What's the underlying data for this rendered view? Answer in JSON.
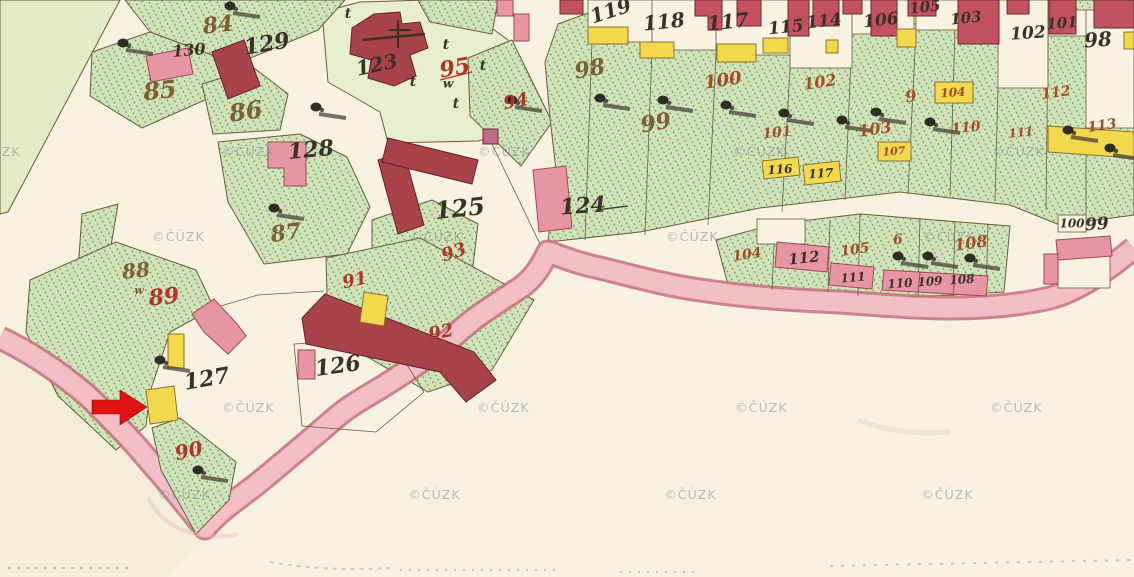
{
  "map": {
    "watermark": {
      "text": "©ČÚZK"
    },
    "watermark_positions": [
      [
        -32,
        156
      ],
      [
        222,
        156
      ],
      [
        478,
        156
      ],
      [
        733,
        156
      ],
      [
        992,
        156
      ],
      [
        152,
        241
      ],
      [
        410,
        241
      ],
      [
        666,
        241
      ],
      [
        923,
        241
      ],
      [
        222,
        412
      ],
      [
        477,
        412
      ],
      [
        735,
        412
      ],
      [
        990,
        412
      ],
      [
        158,
        499
      ],
      [
        408,
        499
      ],
      [
        664,
        499
      ],
      [
        921,
        499
      ]
    ],
    "colors": {
      "paper": "#f6f2df",
      "meadow_green": "#e2eac6",
      "garden_green": "#cfe2b8",
      "hatch_green": "#57814b",
      "churchyard_green": "#e8edcb",
      "masonry_building_red": "#a8434a",
      "masonry_building_light_red": "#c4525e",
      "building_pink": "#e795a5",
      "wooden_building_yellow": "#f1d84d",
      "road_pink": "#f3bdc7",
      "road_edge": "#c4707e",
      "ink_black": "#3a3128",
      "ink_red": "#b03427",
      "ink_rust": "#a24d28",
      "ink_sepia": "#7d5f35",
      "annotation_arrow_red": "#e01313",
      "watermark_gray": "#878d94"
    },
    "labels": [
      {
        "t": "130",
        "x": 189,
        "y": 51,
        "s": 16,
        "ink": "black",
        "r": -5
      },
      {
        "t": "129",
        "x": 267,
        "y": 45,
        "s": 22,
        "ink": "black",
        "r": -10
      },
      {
        "t": "128",
        "x": 311,
        "y": 151,
        "s": 22,
        "ink": "black",
        "r": -5
      },
      {
        "t": "127",
        "x": 207,
        "y": 380,
        "s": 22,
        "ink": "black",
        "r": -10
      },
      {
        "t": "126",
        "x": 338,
        "y": 367,
        "s": 22,
        "ink": "black",
        "r": -8
      },
      {
        "t": "125",
        "x": 460,
        "y": 210,
        "s": 24,
        "ink": "black",
        "r": -6
      },
      {
        "t": "124",
        "x": 583,
        "y": 207,
        "s": 22,
        "ink": "black",
        "r": -4
      },
      {
        "t": "123",
        "x": 377,
        "y": 66,
        "s": 20,
        "ink": "black",
        "r": -12
      },
      {
        "t": "119",
        "x": 611,
        "y": 12,
        "s": 20,
        "ink": "black",
        "r": -18
      },
      {
        "t": "118",
        "x": 664,
        "y": 23,
        "s": 20,
        "ink": "black",
        "r": -6
      },
      {
        "t": "117",
        "x": 728,
        "y": 23,
        "s": 20,
        "ink": "black",
        "r": -6
      },
      {
        "t": "115",
        "x": 786,
        "y": 28,
        "s": 17,
        "ink": "black",
        "r": -6
      },
      {
        "t": "114",
        "x": 824,
        "y": 22,
        "s": 17,
        "ink": "black",
        "r": -6
      },
      {
        "t": "106",
        "x": 881,
        "y": 21,
        "s": 17,
        "ink": "black",
        "r": -6
      },
      {
        "t": "105",
        "x": 925,
        "y": 8,
        "s": 15,
        "ink": "black",
        "r": -6
      },
      {
        "t": "103",
        "x": 966,
        "y": 19,
        "s": 15,
        "ink": "black",
        "r": -6
      },
      {
        "t": "102",
        "x": 1028,
        "y": 34,
        "s": 17,
        "ink": "black",
        "r": -4
      },
      {
        "t": "101",
        "x": 1062,
        "y": 24,
        "s": 15,
        "ink": "black",
        "r": -4
      },
      {
        "t": "98",
        "x": 1098,
        "y": 41,
        "s": 20,
        "ink": "black",
        "r": -4
      },
      {
        "t": "99",
        "x": 1097,
        "y": 225,
        "s": 17,
        "ink": "black",
        "r": -4
      },
      {
        "t": "100",
        "x": 1072,
        "y": 224,
        "s": 12,
        "ink": "black",
        "r": 0
      },
      {
        "t": "112",
        "x": 804,
        "y": 259,
        "s": 15,
        "ink": "black",
        "r": -6
      },
      {
        "t": "111",
        "x": 853,
        "y": 278,
        "s": 12,
        "ink": "black",
        "r": -5
      },
      {
        "t": "110",
        "x": 900,
        "y": 284,
        "s": 12,
        "ink": "black",
        "r": -4
      },
      {
        "t": "109",
        "x": 930,
        "y": 282,
        "s": 12,
        "ink": "black",
        "r": -4
      },
      {
        "t": "108",
        "x": 962,
        "y": 280,
        "s": 12,
        "ink": "black",
        "r": -4
      },
      {
        "t": "116",
        "x": 780,
        "y": 170,
        "s": 12,
        "ink": "black",
        "r": -4
      },
      {
        "t": "117",
        "x": 821,
        "y": 174,
        "s": 12,
        "ink": "black",
        "r": -4
      },
      {
        "t": "t",
        "x": 348,
        "y": 14,
        "s": 14,
        "ink": "black",
        "r": 0
      },
      {
        "t": "t",
        "x": 446,
        "y": 45,
        "s": 14,
        "ink": "black",
        "r": 0
      },
      {
        "t": "t",
        "x": 483,
        "y": 66,
        "s": 14,
        "ink": "black",
        "r": 0
      },
      {
        "t": "t",
        "x": 413,
        "y": 82,
        "s": 14,
        "ink": "black",
        "r": 0
      },
      {
        "t": "t",
        "x": 456,
        "y": 104,
        "s": 14,
        "ink": "black",
        "r": 0
      },
      {
        "t": "w",
        "x": 448,
        "y": 84,
        "s": 12,
        "ink": "black",
        "r": 0
      },
      {
        "t": "89",
        "x": 164,
        "y": 298,
        "s": 22,
        "ink": "red",
        "r": -6
      },
      {
        "t": "90",
        "x": 189,
        "y": 452,
        "s": 20,
        "ink": "red",
        "r": -12
      },
      {
        "t": "91",
        "x": 355,
        "y": 281,
        "s": 18,
        "ink": "red",
        "r": -12
      },
      {
        "t": "92",
        "x": 441,
        "y": 333,
        "s": 18,
        "ink": "red",
        "r": -10
      },
      {
        "t": "93",
        "x": 454,
        "y": 253,
        "s": 18,
        "ink": "red",
        "r": -18
      },
      {
        "t": "94",
        "x": 516,
        "y": 102,
        "s": 18,
        "ink": "red",
        "r": -10
      },
      {
        "t": "95",
        "x": 455,
        "y": 69,
        "s": 22,
        "ink": "red",
        "r": -10
      },
      {
        "t": "100",
        "x": 723,
        "y": 81,
        "s": 18,
        "ink": "rust",
        "r": -8
      },
      {
        "t": "101",
        "x": 777,
        "y": 133,
        "s": 14,
        "ink": "rust",
        "r": -6
      },
      {
        "t": "102",
        "x": 820,
        "y": 83,
        "s": 16,
        "ink": "rust",
        "r": -8
      },
      {
        "t": "103",
        "x": 875,
        "y": 130,
        "s": 16,
        "ink": "rust",
        "r": -8
      },
      {
        "t": "104",
        "x": 953,
        "y": 93,
        "s": 12,
        "ink": "rust",
        "r": -4
      },
      {
        "t": "107",
        "x": 894,
        "y": 152,
        "s": 11,
        "ink": "rust",
        "r": -4
      },
      {
        "t": "9",
        "x": 911,
        "y": 97,
        "s": 16,
        "ink": "rust",
        "r": -8
      },
      {
        "t": "110",
        "x": 966,
        "y": 128,
        "s": 14,
        "ink": "rust",
        "r": -6
      },
      {
        "t": "111",
        "x": 1021,
        "y": 133,
        "s": 12,
        "ink": "rust",
        "r": -6
      },
      {
        "t": "112",
        "x": 1056,
        "y": 93,
        "s": 14,
        "ink": "rust",
        "r": -8
      },
      {
        "t": "113",
        "x": 1102,
        "y": 126,
        "s": 14,
        "ink": "rust",
        "r": -8
      },
      {
        "t": "104",
        "x": 747,
        "y": 255,
        "s": 14,
        "ink": "rust",
        "r": -8
      },
      {
        "t": "105",
        "x": 855,
        "y": 250,
        "s": 14,
        "ink": "rust",
        "r": -8
      },
      {
        "t": "6",
        "x": 898,
        "y": 240,
        "s": 14,
        "ink": "rust",
        "r": -5
      },
      {
        "t": "108",
        "x": 971,
        "y": 244,
        "s": 16,
        "ink": "rust",
        "r": -8
      },
      {
        "t": "84",
        "x": 218,
        "y": 26,
        "s": 22,
        "ink": "sepia",
        "r": -6
      },
      {
        "t": "85",
        "x": 160,
        "y": 92,
        "s": 24,
        "ink": "sepia",
        "r": -6
      },
      {
        "t": "86",
        "x": 246,
        "y": 113,
        "s": 24,
        "ink": "sepia",
        "r": -8
      },
      {
        "t": "87",
        "x": 286,
        "y": 234,
        "s": 22,
        "ink": "sepia",
        "r": -8
      },
      {
        "t": "88",
        "x": 136,
        "y": 272,
        "s": 20,
        "ink": "sepia",
        "r": -6
      },
      {
        "t": "98",
        "x": 590,
        "y": 70,
        "s": 22,
        "ink": "sepia",
        "r": -10
      },
      {
        "t": "99",
        "x": 656,
        "y": 124,
        "s": 22,
        "ink": "sepia",
        "r": -10
      },
      {
        "t": "w",
        "x": 139,
        "y": 291,
        "s": 11,
        "ink": "sepia",
        "r": 0
      }
    ],
    "tree_symbols": [
      [
        123,
        43
      ],
      [
        230,
        6
      ],
      [
        316,
        107
      ],
      [
        274,
        208
      ],
      [
        160,
        360
      ],
      [
        198,
        470
      ],
      [
        600,
        98
      ],
      [
        663,
        100
      ],
      [
        726,
        105
      ],
      [
        784,
        113
      ],
      [
        842,
        120
      ],
      [
        876,
        112
      ],
      [
        930,
        122
      ],
      [
        1068,
        130
      ],
      [
        1110,
        148
      ],
      [
        512,
        100
      ],
      [
        898,
        256
      ],
      [
        928,
        256
      ],
      [
        970,
        258
      ]
    ],
    "annotation_arrow": {
      "direction": "right",
      "color": "#e01313",
      "x": 92,
      "y": 390,
      "width": 55,
      "height": 35
    }
  }
}
